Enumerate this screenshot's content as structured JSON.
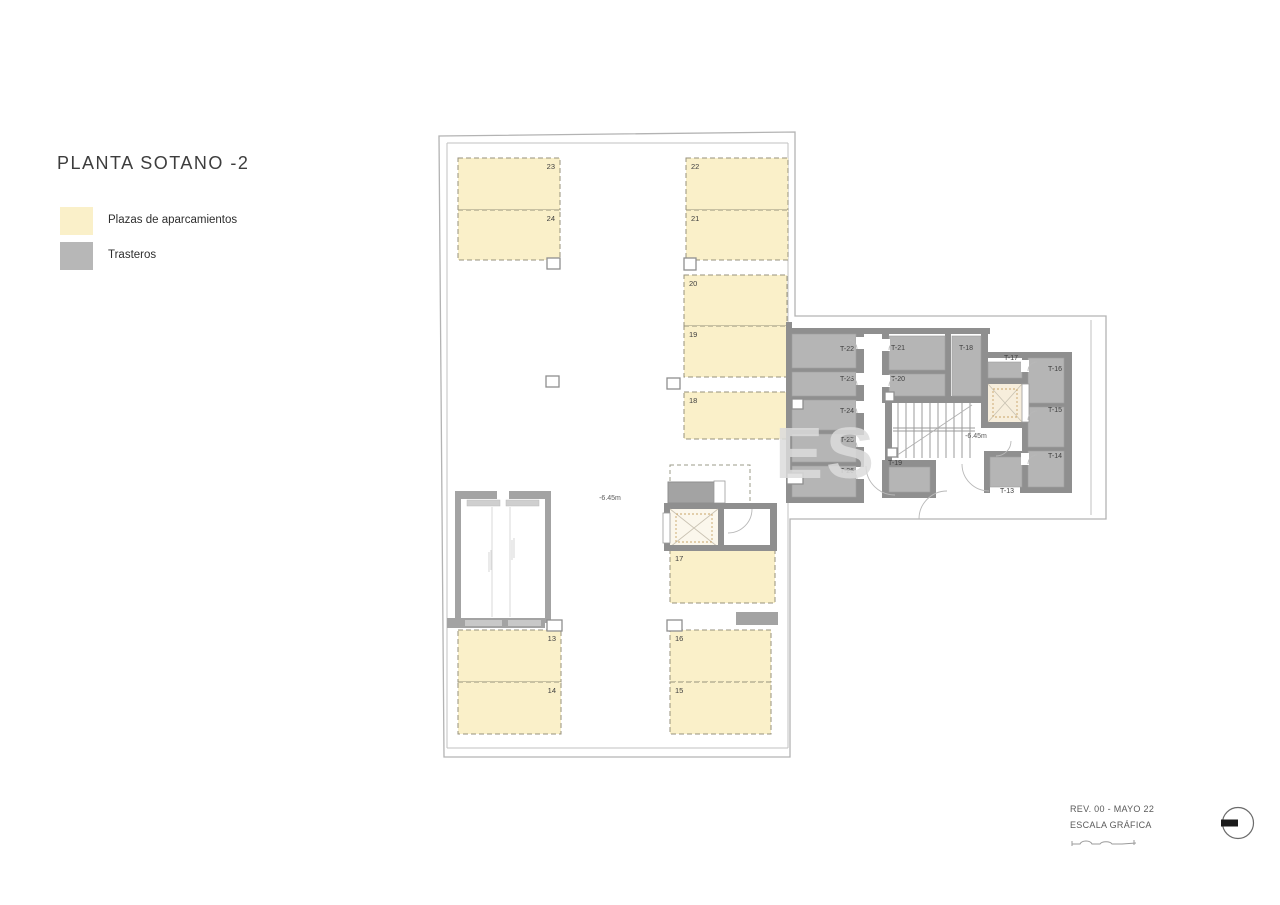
{
  "title": "PLANTA SOTANO -2",
  "legend": {
    "items": [
      {
        "label": "Plazas de aparcamientos",
        "color": "#FAF0C9"
      },
      {
        "label": "Trasteros",
        "color": "#B7B7B7"
      }
    ]
  },
  "colors": {
    "parking_fill": "#FAF0C9",
    "parking_dash": "#97927C",
    "trastero_fill": "#B5B5B5",
    "wall": "#8F8F8F",
    "outline": "#B3B3B3",
    "elevator_fill": "#F7EEDC",
    "elevator_dash": "#C8A468",
    "label_text": "#3F3F3F"
  },
  "plan": {
    "watermark": "ES",
    "floor_level_labels": [
      {
        "text": "-6.45m",
        "x": 610,
        "y": 500
      },
      {
        "text": "-6.45m",
        "x": 976,
        "y": 438
      }
    ],
    "parking_spaces": [
      {
        "id": "23",
        "x": 458,
        "y": 158,
        "w": 102,
        "h": 52,
        "corner": "tr"
      },
      {
        "id": "24",
        "x": 458,
        "y": 210,
        "w": 102,
        "h": 50,
        "corner": "tr"
      },
      {
        "id": "22",
        "x": 686,
        "y": 158,
        "w": 102,
        "h": 52,
        "corner": "tl"
      },
      {
        "id": "21",
        "x": 686,
        "y": 210,
        "w": 102,
        "h": 50,
        "corner": "tl"
      },
      {
        "id": "20",
        "x": 684,
        "y": 275,
        "w": 103,
        "h": 51,
        "corner": "tl"
      },
      {
        "id": "19",
        "x": 684,
        "y": 326,
        "w": 103,
        "h": 51,
        "corner": "tl"
      },
      {
        "id": "18",
        "x": 684,
        "y": 392,
        "w": 104,
        "h": 47,
        "corner": "tl"
      },
      {
        "id": "17",
        "x": 670,
        "y": 550,
        "w": 105,
        "h": 53,
        "corner": "tl"
      },
      {
        "id": "13",
        "x": 458,
        "y": 630,
        "w": 103,
        "h": 52,
        "corner": "tr"
      },
      {
        "id": "14",
        "x": 458,
        "y": 682,
        "w": 103,
        "h": 52,
        "corner": "tr"
      },
      {
        "id": "16",
        "x": 670,
        "y": 630,
        "w": 101,
        "h": 52,
        "corner": "tl"
      },
      {
        "id": "15",
        "x": 670,
        "y": 682,
        "w": 101,
        "h": 52,
        "corner": "tl"
      }
    ],
    "trasteros": [
      {
        "id": "T-22",
        "x": 792,
        "y": 334,
        "w": 64,
        "h": 34,
        "label": {
          "x": 854,
          "y": 351,
          "anchor": "end"
        }
      },
      {
        "id": "T-23",
        "x": 792,
        "y": 372,
        "w": 64,
        "h": 24,
        "label": {
          "x": 854,
          "y": 381,
          "anchor": "end"
        }
      },
      {
        "id": "T-24",
        "x": 792,
        "y": 400,
        "w": 64,
        "h": 30,
        "label": {
          "x": 854,
          "y": 413,
          "anchor": "end"
        }
      },
      {
        "id": "T-25",
        "x": 792,
        "y": 434,
        "w": 64,
        "h": 28,
        "label": {
          "x": 854,
          "y": 442,
          "anchor": "end"
        }
      },
      {
        "id": "T-26",
        "x": 792,
        "y": 466,
        "w": 64,
        "h": 31,
        "label": {
          "x": 854,
          "y": 473,
          "anchor": "end"
        }
      },
      {
        "id": "T-21",
        "x": 889,
        "y": 336,
        "w": 56,
        "h": 34,
        "label": {
          "x": 891,
          "y": 350,
          "anchor": "start"
        }
      },
      {
        "id": "T-20",
        "x": 889,
        "y": 374,
        "w": 56,
        "h": 22,
        "label": {
          "x": 891,
          "y": 381,
          "anchor": "start"
        }
      },
      {
        "id": "T-18",
        "x": 952,
        "y": 336,
        "w": 29,
        "h": 60,
        "label": {
          "x": 959,
          "y": 350,
          "anchor": "start"
        }
      },
      {
        "id": "T-17",
        "x": 988,
        "y": 362,
        "w": 34,
        "h": 16,
        "label": {
          "x": 1004,
          "y": 360,
          "anchor": "start"
        }
      },
      {
        "id": "T-16",
        "x": 1028,
        "y": 358,
        "w": 36,
        "h": 45,
        "label": {
          "x": 1062,
          "y": 371,
          "anchor": "end"
        }
      },
      {
        "id": "T-15",
        "x": 1028,
        "y": 407,
        "w": 36,
        "h": 40,
        "label": {
          "x": 1062,
          "y": 412,
          "anchor": "end"
        }
      },
      {
        "id": "T-14",
        "x": 1028,
        "y": 451,
        "w": 36,
        "h": 36,
        "label": {
          "x": 1062,
          "y": 458,
          "anchor": "end"
        }
      },
      {
        "id": "T-13",
        "x": 990,
        "y": 457,
        "w": 32,
        "h": 30,
        "label": {
          "x": 1000,
          "y": 493,
          "anchor": "start"
        }
      },
      {
        "id": "T-19",
        "x": 889,
        "y": 467,
        "w": 41,
        "h": 25,
        "label": {
          "x": 888,
          "y": 465,
          "anchor": "start"
        }
      }
    ]
  },
  "footer": {
    "revision": "REV. 00 - MAYO 22",
    "scale_label": "ESCALA GRÁFICA",
    "symbols": {
      "scale_bar": "graphic-scale",
      "orientation": "circle-with-bar"
    }
  }
}
